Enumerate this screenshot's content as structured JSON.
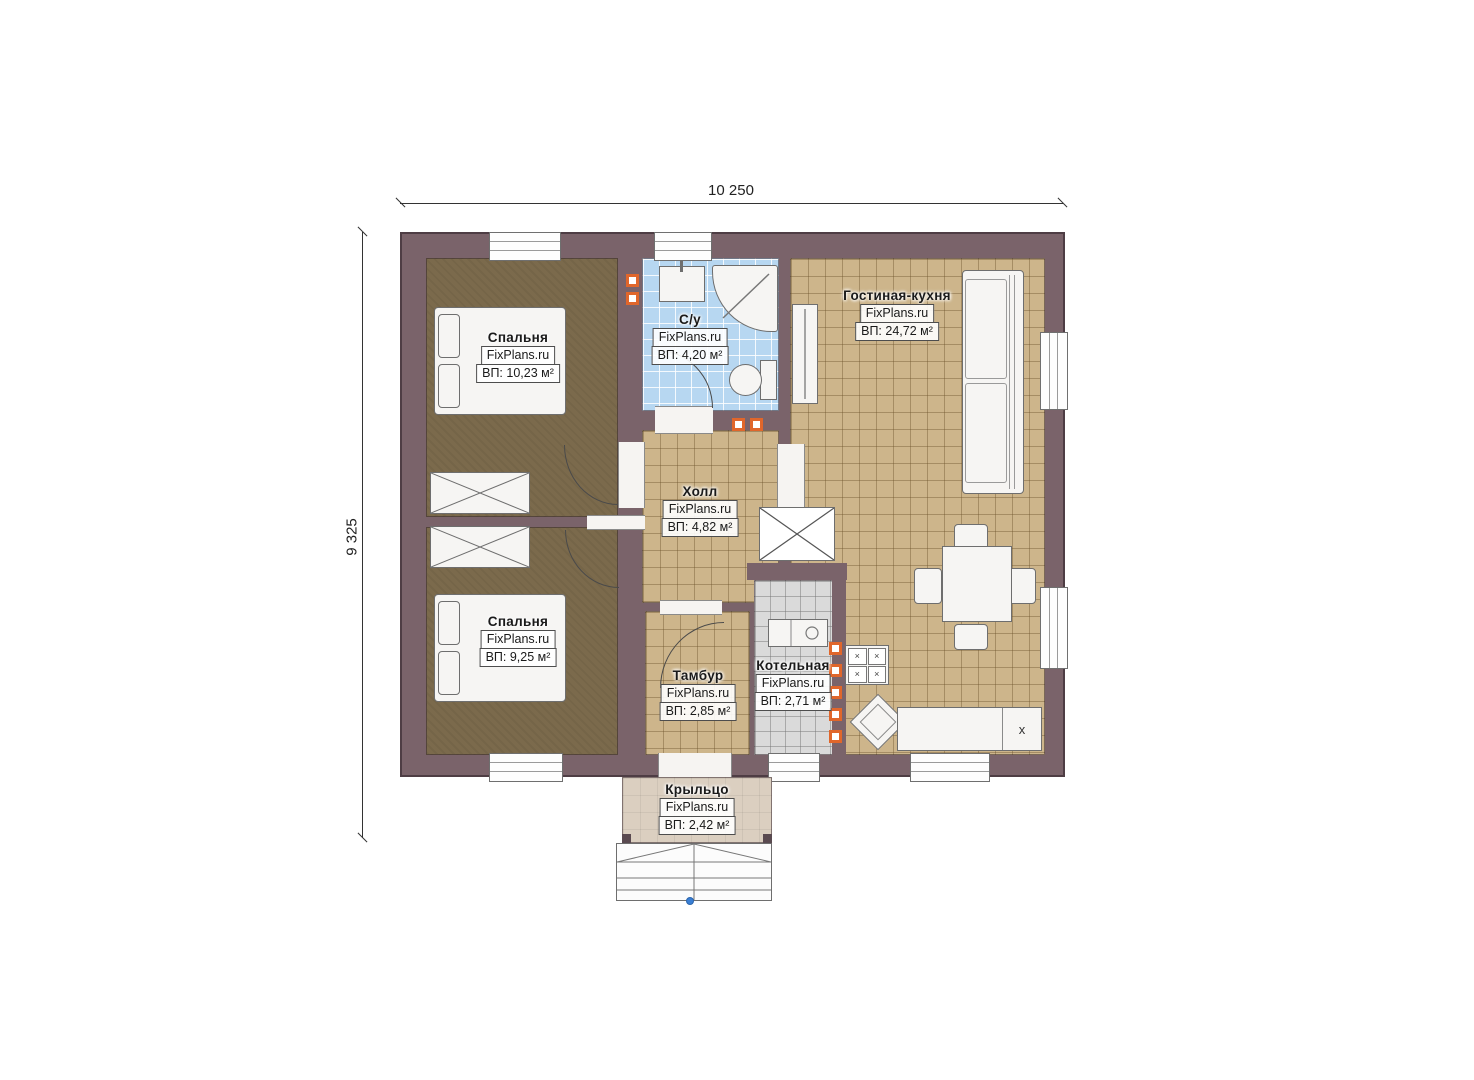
{
  "branding": {
    "watermark": "FixPlans.ru"
  },
  "dimensions": {
    "width_label": "10 250",
    "height_label": "9 325"
  },
  "rooms": {
    "bedroom1": {
      "name": "Спальня",
      "area": "ВП: 10,23 м²"
    },
    "bathroom": {
      "name": "С/у",
      "area": "ВП: 4,20 м²"
    },
    "hall": {
      "name": "Холл",
      "area": "ВП: 4,82 м²"
    },
    "living": {
      "name": "Гостиная-кухня",
      "area": "ВП: 24,72 м²"
    },
    "bedroom2": {
      "name": "Спальня",
      "area": "ВП: 9,25 м²"
    },
    "tambour": {
      "name": "Тамбур",
      "area": "ВП: 2,85 м²"
    },
    "boiler": {
      "name": "Котельная",
      "area": "ВП: 2,71 м²"
    },
    "porch": {
      "name": "Крыльцо",
      "area": "ВП: 2,42 м²"
    }
  },
  "kitchen": {
    "appliance_label": "x",
    "burner_glyph": "×"
  },
  "colors": {
    "wall": "#7a636a",
    "floor_tan": "#cdb58b",
    "floor_bath": "#b7d7f1",
    "floor_bedroom": "#7b6a4c",
    "floor_boiler": "#dadada",
    "floor_porch": "#dbcfc0",
    "radiator": "#e0662b"
  }
}
